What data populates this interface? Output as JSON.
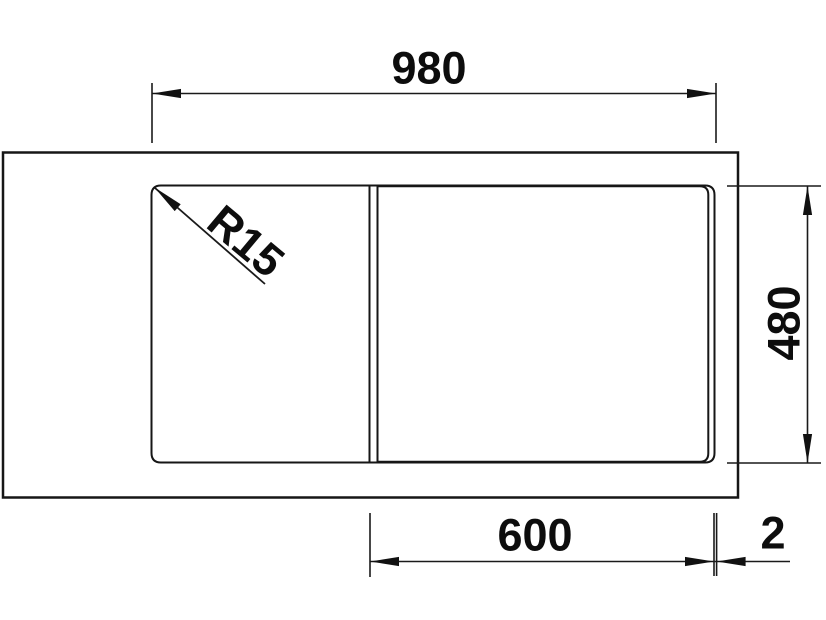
{
  "drawing": {
    "colors": {
      "line": "#161616",
      "background": "#ffffff"
    },
    "labels": {
      "width_total": "980",
      "depth_total": "480",
      "bowl_width": "600",
      "edge_offset": "2",
      "corner_radius": "R15"
    }
  }
}
